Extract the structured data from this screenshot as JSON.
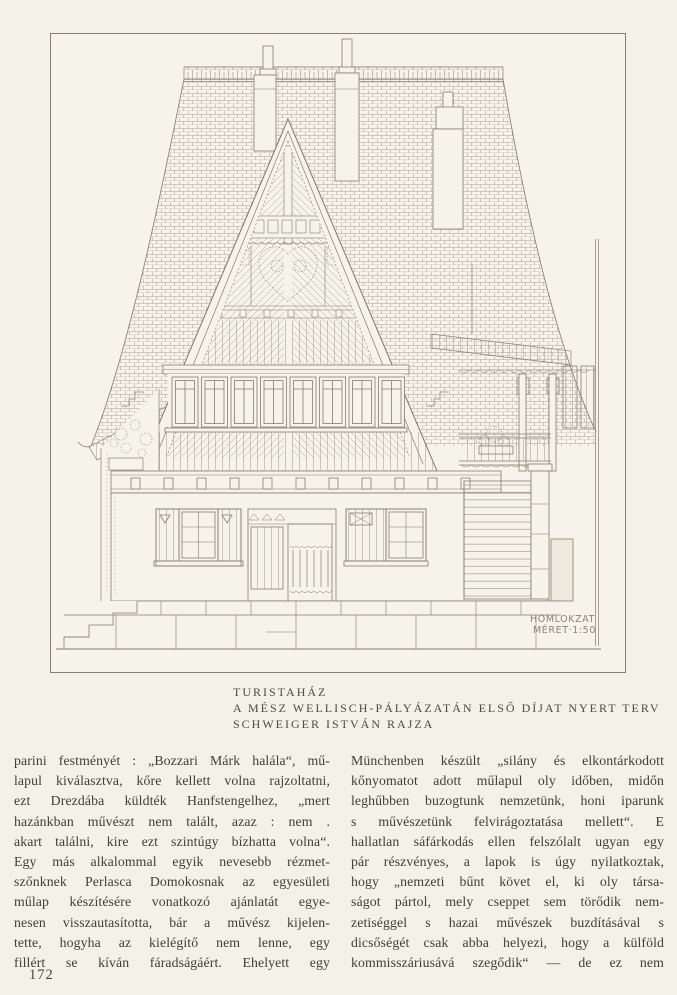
{
  "page": {
    "number": "172"
  },
  "figure": {
    "caption": [
      "TURISTAHÁZ",
      "A MÉSZ WELLISCH-PÁLYÁZATÁN ELSŐ DÍJAT NYERT TERV",
      "SCHWEIGER ISTVÁN RAJZA"
    ],
    "plan_label": [
      "HOMLOKZAT",
      "MÉRET·1:50"
    ],
    "ink_color": "#837d6f",
    "paper_color": "#f6f3ea"
  },
  "article": {
    "left_lines": [
      "parini festményét : „Bozzari Márk halála“, mű-",
      "lapul kiválasztva, kőre kellett volna rajzoltatni,",
      "ezt Drezdába küldték Hanfstengelhez, „mert",
      "hazánkban művészt nem talált, azaz : nem .",
      "akart találni, kire ezt szintúgy bízhatta volna“.",
      "Egy más alkalommal egyik nevesebb rézmet-",
      "szőnknek Perlasca Domokosnak az egyesületi",
      "műlap készítésére vonatkozó ajánlatát egye-",
      "nesen visszautasította, bár a művész kijelen-",
      "tette, hogyha az kielégítő nem lenne, egy",
      "fillért se kíván fáradságáért. Ehelyett egy"
    ],
    "right_lines": [
      "Münchenben készült „silány és elkontárkodott",
      "kőnyomatot adott műlapul oly időben, midőn",
      "leghűbben buzogtunk nemzetünk, honi iparunk",
      "s művészetünk felvirágoztatása mellett“. E",
      "hallatlan sáfárkodás ellen felszólalt ugyan egy",
      "pár részvényes, a lapok is úgy nyilatkoztak,",
      "hogy „nemzeti bűnt követ el, ki oly társa-",
      "ságot pártol, mely cseppet sem törődik nem-",
      "zetiséggel s hazai művészek buzdításával s",
      "dicsőségét csak abba helyezi, hogy a külföld",
      "kommisszáriusává szegődik“ — de ez nem"
    ]
  }
}
